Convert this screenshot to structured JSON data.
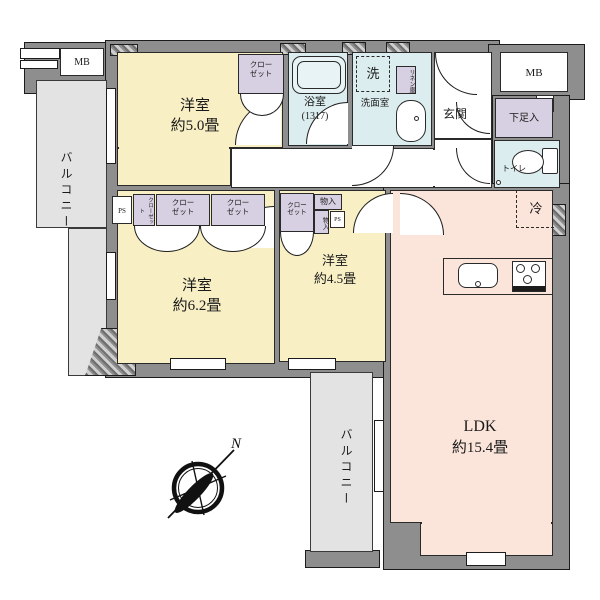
{
  "plan": {
    "rooms": {
      "bedroom1": {
        "name": "洋室",
        "area": "約5.0畳"
      },
      "bedroom2": {
        "name": "洋室",
        "area": "約6.2畳"
      },
      "bedroom3": {
        "name": "洋室",
        "area": "約4.5畳"
      },
      "ldk": {
        "name": "LDK",
        "area": "約15.4畳"
      },
      "bathroom": {
        "name": "浴室",
        "size": "(1317)"
      },
      "washroom": {
        "name": "洗面室"
      },
      "entrance": {
        "name": "玄関"
      },
      "toilet": {
        "name": "トイレ"
      },
      "balcony": {
        "name": "バルコニー"
      }
    },
    "fixtures": {
      "meter_box": "MB",
      "pipe_shaft": "PS",
      "closet_line1": "クロー",
      "closet_line2": "ゼット",
      "closet_full": "クローゼット",
      "storage": "物入",
      "linen": "リネン庫",
      "laundry": "洗",
      "shoe_cabinet": "下足入",
      "refrigerator": "冷"
    },
    "compass": {
      "north": "N"
    },
    "colors": {
      "wall": "#8e8e8e",
      "room_yellow": "#f8efc5",
      "room_pink": "#fbe5db",
      "wet_blue": "#dcedef",
      "closet_purple": "#d7d0e2",
      "balcony_gray": "#e3e3e3"
    }
  }
}
